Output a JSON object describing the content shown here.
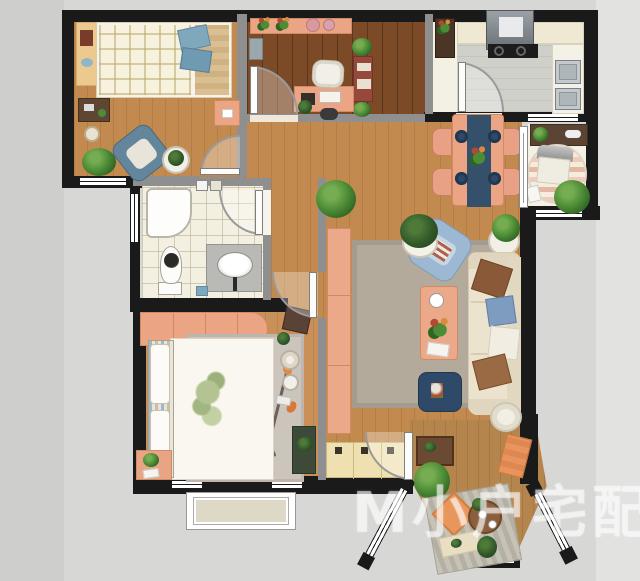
{
  "watermark": {
    "logo": "M",
    "text": "小户宅配"
  },
  "palette": {
    "wall": "#1a1a1a",
    "interior_wall": "#8f8f8f",
    "wood_light": "#c28a4f",
    "wood_dark": "#7d4a28",
    "wood_master": "#c99159",
    "salmon": "#eba585",
    "navy": "#2e4a68",
    "slate_blue_chair": "#64869c",
    "light_blue_chair": "#9db8d2",
    "cream_sofa": "#ece3cf",
    "living_rug": "#b3aa9b",
    "bath_tile": "#f3f0e2",
    "kitchen_floor": "#d0d0cb",
    "plant_green": "#4d8c36",
    "accent_orange": "#e8945c",
    "exterior": "#d7d7d6"
  },
  "rooms": [
    {
      "id": "bedroom-2",
      "furniture": [
        "plaid-bed",
        "wall-desk",
        "armchair",
        "side-table",
        "plant",
        "nightstand",
        "writing-desk",
        "stool"
      ]
    },
    {
      "id": "study",
      "furniture": [
        "top-shelf",
        "plants",
        "desk",
        "office-chair",
        "red-cabinet",
        "appliance"
      ]
    },
    {
      "id": "kitchen",
      "furniture": [
        "counter",
        "range-hood",
        "cooktop",
        "double-sink"
      ]
    },
    {
      "id": "dining-area",
      "furniture": [
        "table",
        "runner",
        "four-chairs",
        "plates",
        "flowers"
      ]
    },
    {
      "id": "sunroom-nook",
      "furniture": [
        "desk",
        "lounge-chair",
        "round-striped-rug",
        "plant"
      ]
    },
    {
      "id": "living-room",
      "furniture": [
        "sofa",
        "pillows",
        "armchair",
        "coffee-table",
        "rug",
        "pouf",
        "side-tables",
        "plants",
        "sideboard",
        "entry-mat"
      ]
    },
    {
      "id": "bathroom",
      "furniture": [
        "shower",
        "toilet",
        "vanity-sink",
        "washer-shelf"
      ]
    },
    {
      "id": "master-bedroom",
      "furniture": [
        "wardrobe",
        "floral-bed",
        "leaf-rug",
        "nightstand",
        "plant",
        "tea-set",
        "dark-mat"
      ]
    },
    {
      "id": "entry",
      "furniture": [
        "shoe-cabinet",
        "front-door"
      ]
    },
    {
      "id": "bay-balcony",
      "furniture": [
        "striped-mat",
        "orange-cushion",
        "tea-table",
        "bench",
        "plants",
        "orange-lounge"
      ]
    }
  ]
}
